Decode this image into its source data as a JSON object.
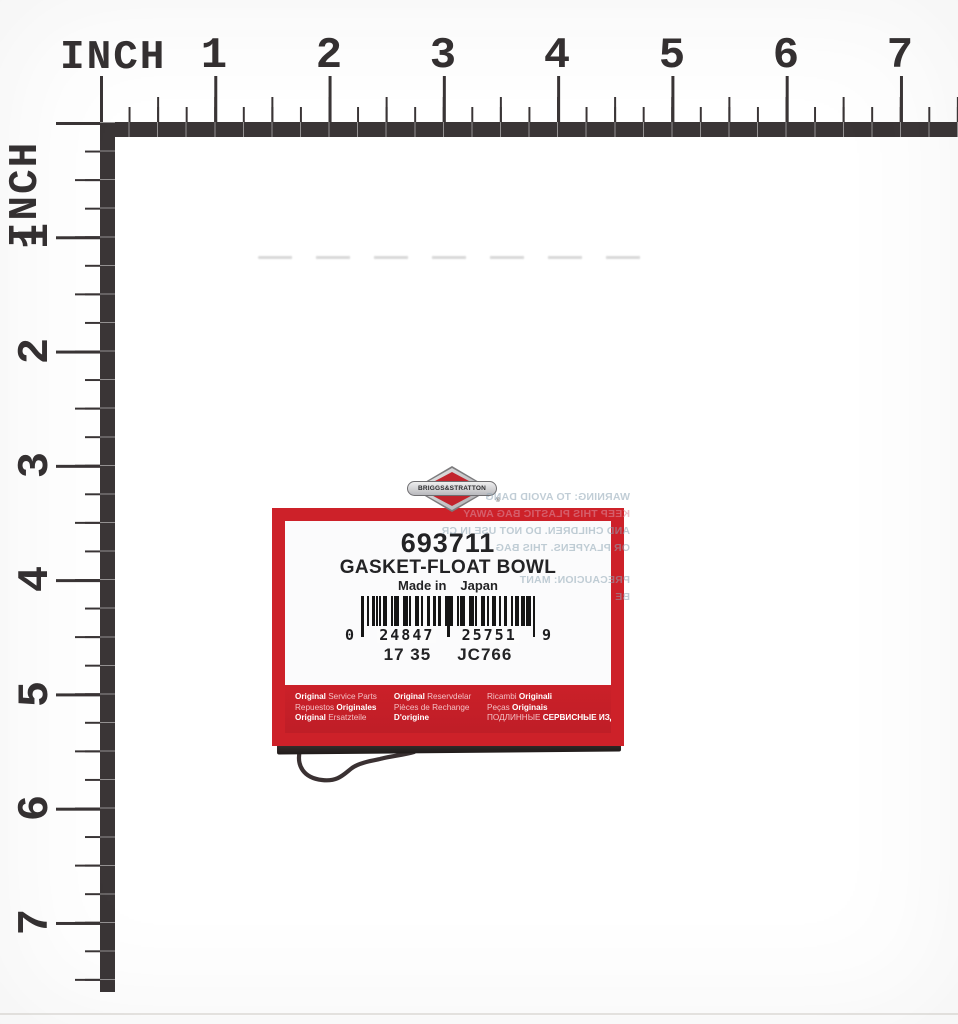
{
  "ruler_top": {
    "label": "INCH",
    "numbers": [
      "1",
      "2",
      "3",
      "4",
      "5",
      "6",
      "7"
    ]
  },
  "ruler_left": {
    "label": "INCH",
    "numbers": [
      "1",
      "2",
      "3",
      "4",
      "5",
      "6",
      "7"
    ]
  },
  "product_label": {
    "brand": "BRIGGS&STRATTON",
    "reg_mark": "®",
    "part_number": "693711",
    "part_name": "GASKET-FLOAT BOWL",
    "made_in": {
      "prefix": "Made in",
      "country": "Japan"
    },
    "barcode": {
      "left_digit": "0",
      "group1": "24847",
      "group2": "25751",
      "right_digit": "9"
    },
    "date_code": "17 35",
    "vendor_code": "JC766",
    "band": {
      "col1": {
        "l1b": "Original",
        "l1r": " Service Parts",
        "l2r": "Repuestos ",
        "l2b": "Originales",
        "l3b": "Original",
        "l3r": " Ersatzteile"
      },
      "col2": {
        "l1b": "Original",
        "l1r": " Reservdelar",
        "l2r": "Pièces de Rechange",
        "l3b": "D'origine"
      },
      "col3": {
        "l1r": "Ricambi ",
        "l1b": "Originali",
        "l2r": "Peças ",
        "l2b": "Originais",
        "l3r": "ПОДЛИННЫЕ ",
        "l3b": "СЕРВИСНЫЕ ИЗДЕЛИЯ"
      }
    }
  },
  "bag_warning": {
    "lines": [
      "WARNING: TO AVOID DANG",
      "KEEP THIS PLASTIC BAG AWAY",
      "AND CHILDREN. DO NOT USE IN CR",
      "OR PLAYPENS. THIS BAG",
      "PRECAUCION: MANT",
      "BE"
    ]
  },
  "colors": {
    "ruler_dark": "#3a3536",
    "label_red": "#cd2129",
    "band_soft_text": "#f3c0c4",
    "warning_gray": "#8fa6b5",
    "warning_pink": "#dd8fa0",
    "logo_silver": "#b9b9bd"
  }
}
